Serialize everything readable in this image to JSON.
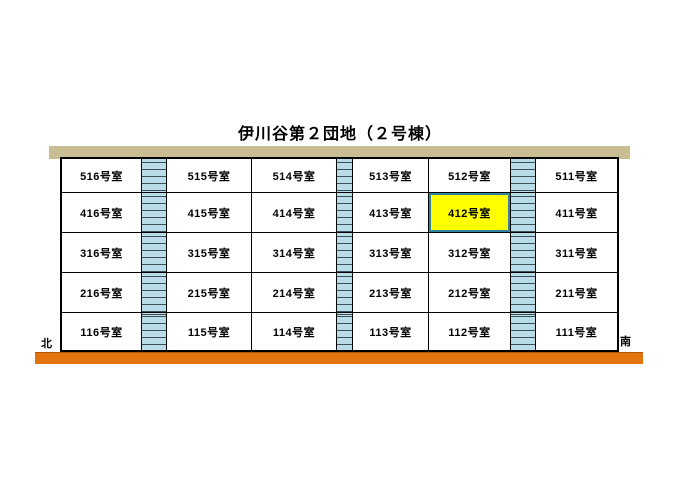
{
  "title": "伊川谷第２団地（２号棟）",
  "compass": {
    "north": "北",
    "south": "南"
  },
  "highlighted_room": "412号室",
  "floors": [
    {
      "rooms": [
        "516号室",
        "515号室",
        "514号室",
        "513号室",
        "512号室",
        "511号室"
      ]
    },
    {
      "rooms": [
        "416号室",
        "415号室",
        "414号室",
        "413号室",
        "412号室",
        "411号室"
      ]
    },
    {
      "rooms": [
        "316号室",
        "315号室",
        "314号室",
        "313号室",
        "312号室",
        "311号室"
      ]
    },
    {
      "rooms": [
        "216号室",
        "215号室",
        "214号室",
        "213号室",
        "212号室",
        "211号室"
      ]
    },
    {
      "rooms": [
        "116号室",
        "115号室",
        "114号室",
        "113号室",
        "112号室",
        "111号室"
      ]
    }
  ],
  "colors": {
    "roof": "#c9bd92",
    "ground": "#e2730e",
    "stairwell": "#b9dde8",
    "stair_line": "#3c5158",
    "highlight_fill": "#ffff00",
    "highlight_border": "#31849b"
  }
}
